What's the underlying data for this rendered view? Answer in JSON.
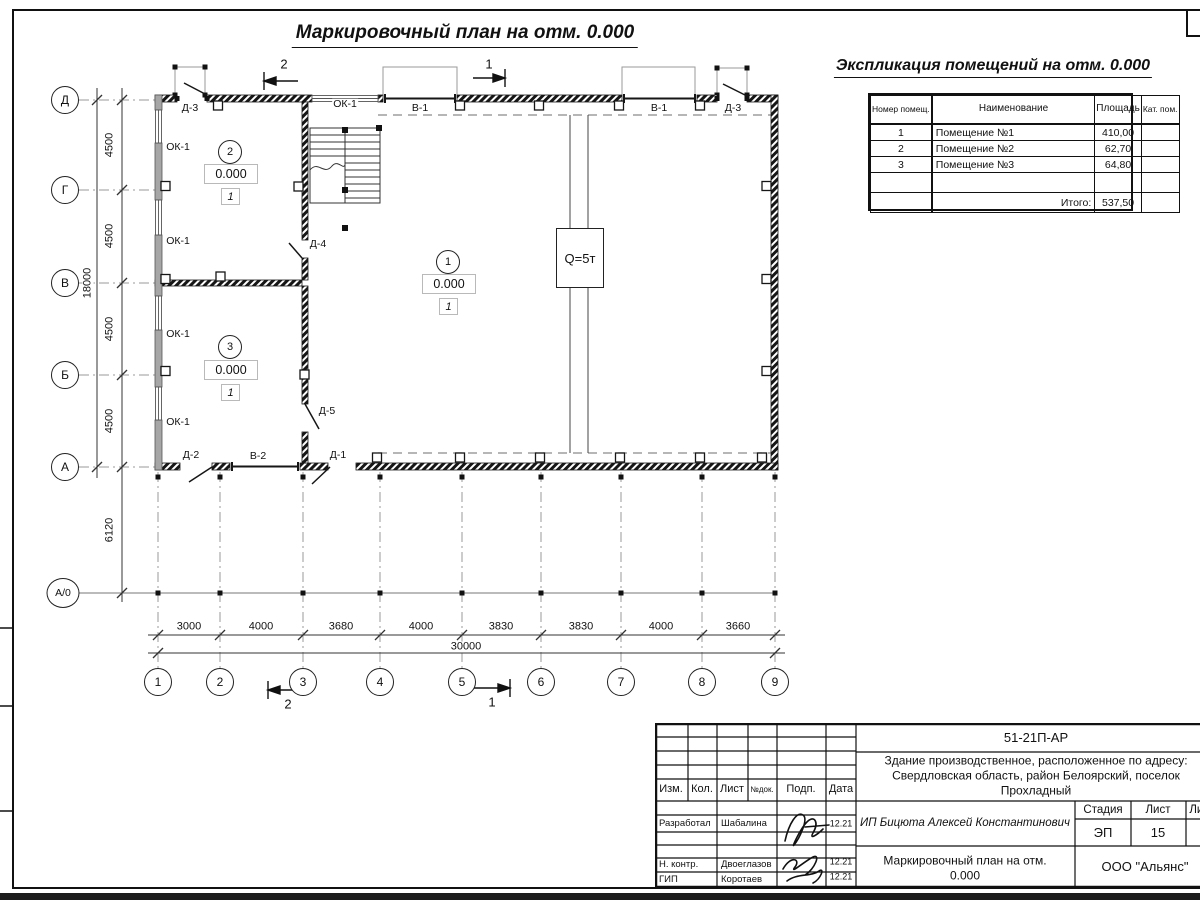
{
  "sheet": {
    "main_title": "Маркировочный план на отм. 0.000"
  },
  "explication": {
    "title": "Экспликация помещений на отм. 0.000",
    "col_num": "Номер помещ.",
    "col_name": "Наименование",
    "col_area": "Площадь",
    "col_cat": "Кат. пом.",
    "rows": [
      {
        "num": "1",
        "name": "Помещение №1",
        "area": "410,00",
        "cat": ""
      },
      {
        "num": "2",
        "name": "Помещение №2",
        "area": "62,70",
        "cat": ""
      },
      {
        "num": "3",
        "name": "Помещение №3",
        "area": "64,80",
        "cat": ""
      }
    ],
    "total_label": "Итого:",
    "total_value": "537,50"
  },
  "plan": {
    "axes_h": [
      "1",
      "2",
      "3",
      "4",
      "5",
      "6",
      "7",
      "8",
      "9"
    ],
    "axes_v": [
      "Д",
      "Г",
      "В",
      "Б",
      "А",
      "А/0"
    ],
    "dims_bottom": [
      "3000",
      "4000",
      "3680",
      "4000",
      "3830",
      "3830",
      "4000",
      "3660"
    ],
    "dim_bottom_total": "30000",
    "dims_left": [
      "4500",
      "4500",
      "4500",
      "4500"
    ],
    "dim_left_total": "18000",
    "dim_canopy": "6120",
    "elevation": "0.000",
    "floor_type": "1",
    "room1": "1",
    "room2": "2",
    "room3": "3",
    "crane": "Q=5т",
    "section1": "1",
    "section2": "2",
    "labels": {
      "ok1": "ОК-1",
      "v1": "В-1",
      "v2": "В-2",
      "d1": "Д-1",
      "d2": "Д-2",
      "d3": "Д-3",
      "d4": "Д-4",
      "d5": "Д-5"
    }
  },
  "title_block": {
    "code": "51-21П-АР",
    "description_l1": "Здание производственное, расположенное по адресу:",
    "description_l2": "Свердловская область, район Белоярский, поселок",
    "description_l3": "Прохладный",
    "client": "ИП Бицюта Алексей Константинович",
    "cols": [
      "Изм.",
      "Кол.",
      "Лист",
      "№док.",
      "Подп.",
      "Дата"
    ],
    "stage_label": "Стадия",
    "sheet_label": "Лист",
    "sheets_label": "Листов",
    "stage": "ЭП",
    "sheet_num": "15",
    "sheets_total": "20",
    "rows": [
      {
        "role": "Разработал",
        "name": "Шабалина",
        "date": "12.21"
      },
      {
        "role": "Н. контр.",
        "name": "Двоеглазов",
        "date": "12.21"
      },
      {
        "role": "ГИП",
        "name": "Коротаев",
        "date": "12.21"
      }
    ],
    "drawing_title_l1": "Маркировочный план на отм.",
    "drawing_title_l2": "0.000",
    "company": "ООО \"Альянс\""
  }
}
